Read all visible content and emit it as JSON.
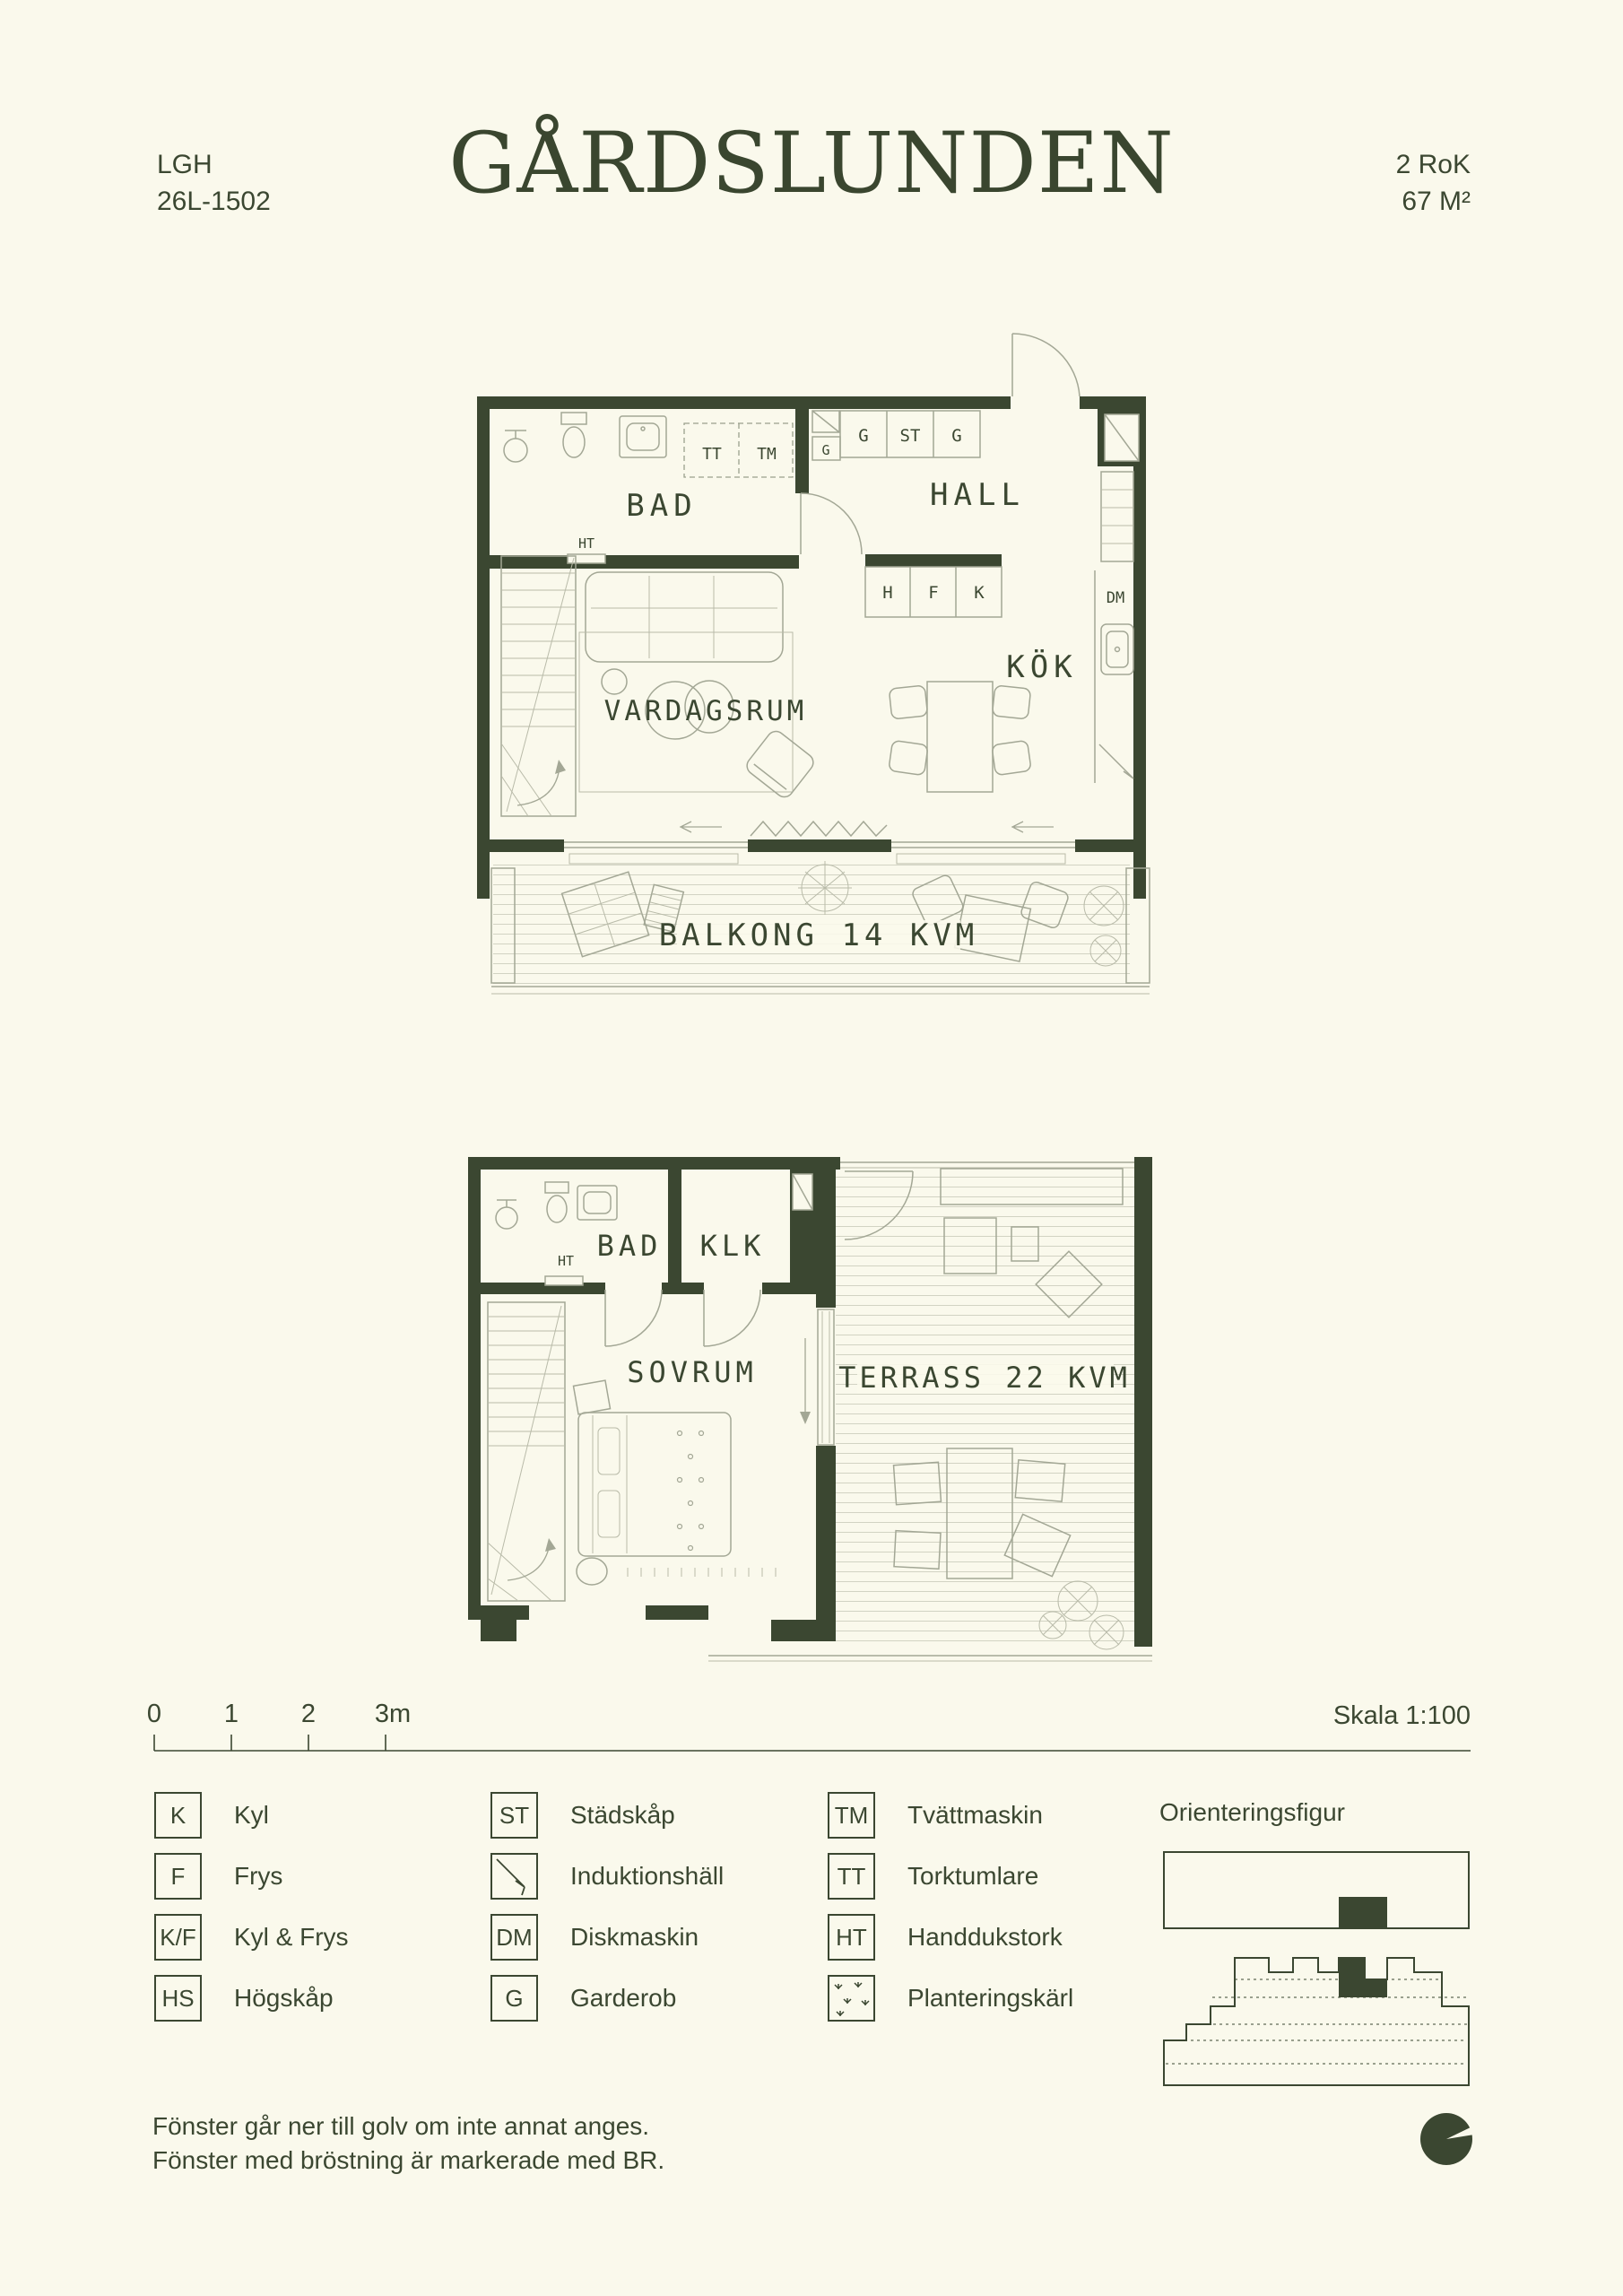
{
  "header": {
    "lgh_label": "LGH",
    "lgh_number": "26L-1502",
    "logo": "GÅRDSLUNDEN",
    "rok": "2 RoK",
    "area": "67 M²"
  },
  "plan_upper": {
    "rooms": {
      "bad": "BAD",
      "hall": "HALL",
      "kok": "KÖK",
      "vardagsrum": "VARDAGSRUM",
      "balkong": "BALKONG 14 KVM"
    },
    "markers": {
      "tt": "TT",
      "tm": "TM",
      "g_a": "G",
      "g_b": "G",
      "st": "ST",
      "g_c": "G",
      "ht": "HT",
      "h": "H",
      "f": "F",
      "k": "K",
      "dm": "DM"
    }
  },
  "plan_lower": {
    "rooms": {
      "bad": "BAD",
      "klk": "KLK",
      "sovrum": "SOVRUM",
      "terrass": "TERRASS 22 KVM"
    },
    "markers": {
      "ht": "HT"
    }
  },
  "scalebar": {
    "t0": "0",
    "t1": "1",
    "t2": "2",
    "t3": "3m",
    "skala": "Skala 1:100"
  },
  "legend": {
    "orientation_title": "Orienteringsfigur",
    "columns": [
      {
        "items": [
          {
            "symbol": "K",
            "icon": null,
            "label": "Kyl"
          },
          {
            "symbol": "F",
            "icon": null,
            "label": "Frys"
          },
          {
            "symbol": "K/F",
            "icon": null,
            "label": "Kyl & Frys"
          },
          {
            "symbol": "HS",
            "icon": null,
            "label": "Högskåp"
          }
        ]
      },
      {
        "items": [
          {
            "symbol": "ST",
            "icon": null,
            "label": "Städskåp"
          },
          {
            "symbol": "",
            "icon": "induction-hob-icon",
            "label": "Induktionshäll"
          },
          {
            "symbol": "DM",
            "icon": null,
            "label": "Diskmaskin"
          },
          {
            "symbol": "G",
            "icon": null,
            "label": "Garderob"
          }
        ]
      },
      {
        "items": [
          {
            "symbol": "TM",
            "icon": null,
            "label": "Tvättmaskin"
          },
          {
            "symbol": "TT",
            "icon": null,
            "label": "Torktumlare"
          },
          {
            "symbol": "HT",
            "icon": null,
            "label": "Handdukstork"
          },
          {
            "symbol": "",
            "icon": "planter-icon",
            "label": "Planteringskärl"
          }
        ]
      }
    ]
  },
  "footer": {
    "line1": "Fönster går ner till golv om inte annat anges.",
    "line2": "Fönster med bröstning är markerade med BR."
  },
  "colors": {
    "background": "#FAF9EC",
    "ink": "#3B4731",
    "thin_line": "#A3A795"
  }
}
